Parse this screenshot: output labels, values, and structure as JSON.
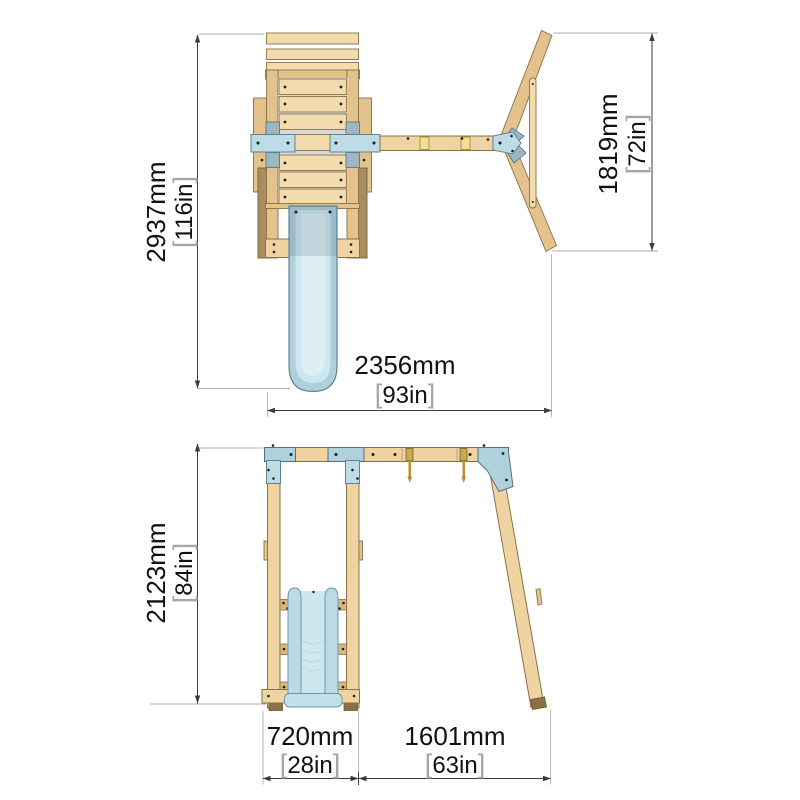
{
  "figure": {
    "type": "product-dimension-diagram",
    "subject": "wooden swing set with platform tower, slide and single swing arm",
    "views": [
      "top-plan-view",
      "front-elevation-view"
    ]
  },
  "dimensions": {
    "bracket_open": "[",
    "bracket_close": "]",
    "top_height": {
      "mm": "2937mm",
      "inches": "116in"
    },
    "top_aframe": {
      "mm": "1819mm",
      "inches": "72in"
    },
    "top_width": {
      "mm": "2356mm",
      "inches": "93in"
    },
    "front_height": {
      "mm": "2123mm",
      "inches": "84in"
    },
    "front_tower": {
      "mm": "720mm",
      "inches": "28in"
    },
    "front_swing": {
      "mm": "1601mm",
      "inches": "63in"
    }
  },
  "palette": {
    "background": "#FFFFFF",
    "wood_light": "#F0D7A6",
    "wood_mid": "#E3C28C",
    "wood_dark": "#AA8D5F",
    "bracket_blue": "#BFDCE6",
    "bracket_blue_dark": "#8FA9B6",
    "slide_blue": "#C5E2EC",
    "hardware_gold": "#C9A94F",
    "dimension_line": "#3C3C3C",
    "extension_line": "#ADADAD",
    "label_text": "#111111",
    "bracket_text": "#A6A6A6"
  }
}
